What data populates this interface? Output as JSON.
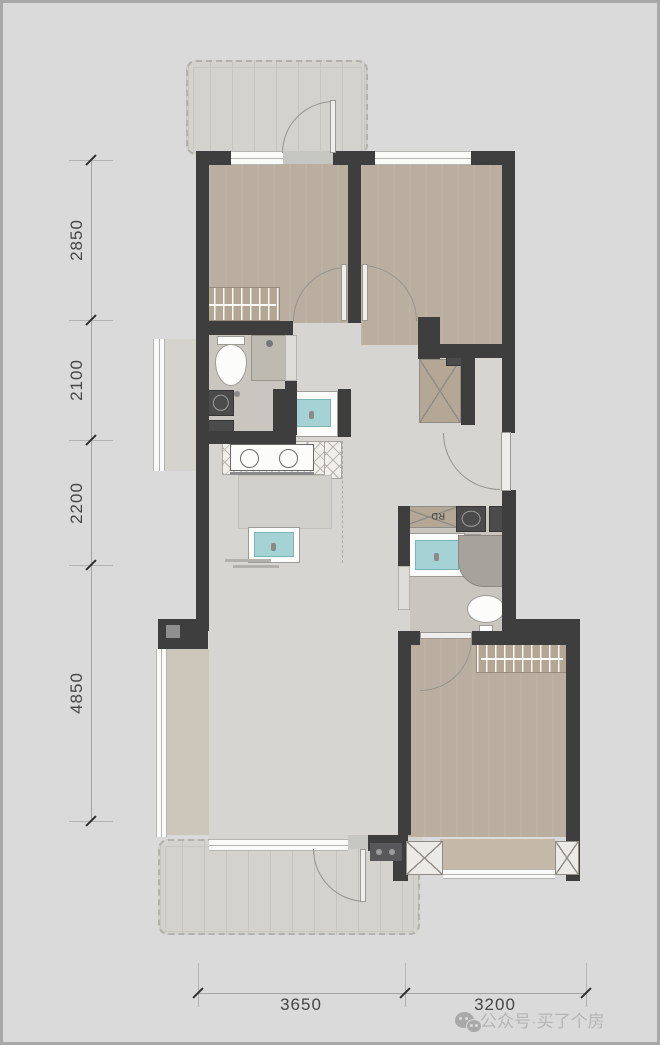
{
  "plan_type": "apartment-floor-plan",
  "dimensions": {
    "left": [
      {
        "label": "2850"
      },
      {
        "label": "2100"
      },
      {
        "label": "2200"
      },
      {
        "label": "4850"
      }
    ],
    "bottom": [
      {
        "label": "3650"
      },
      {
        "label": "3200"
      }
    ]
  },
  "annotations": {
    "riser_duct_label": "RD"
  },
  "watermark": {
    "icon": "wechat-icon",
    "text": "公众号·买了个房"
  },
  "colors": {
    "page_background": "#dadada",
    "wall": "#3e3e3e",
    "bedroom_floor": "#b9ae9f",
    "living_floor": "#d6d5d1",
    "bathroom_tile": "#c9c5bf",
    "balcony_floor": "#d3d2cd",
    "basin_teal": "#a5d2d4",
    "wardrobe_tan": "#b3a695",
    "dimension_text": "#454545",
    "watermark_text": "#b5b5b5"
  }
}
